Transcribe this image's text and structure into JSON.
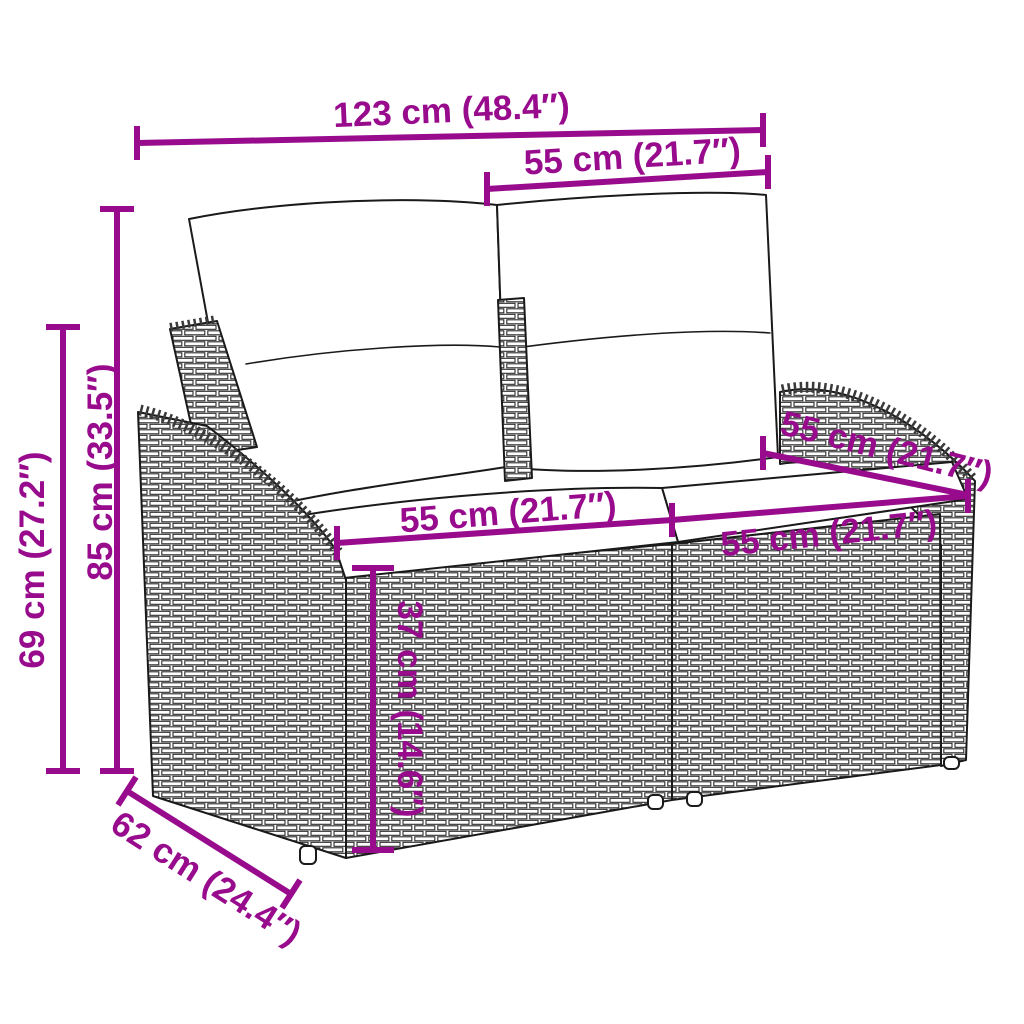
{
  "diagram": {
    "kind": "product-dimension-line-drawing",
    "subject": "poly rattan 2-seater garden sofa with back and seat cushions",
    "background_color": "#FFFFFF",
    "outline_color": "#1A1A1A",
    "dimension_color": "#970B8C",
    "dimensions": {
      "overall_width": "123 cm (48.4″)",
      "backrest_width": "55 cm (21.7″)",
      "overall_height": "85 cm (33.5″)",
      "armrest_height": "69 cm (27.2″)",
      "seat_width_left": "55 cm (21.7″)",
      "seat_width_right": "55 cm (21.7″)",
      "seat_depth": "55 cm (21.7″)",
      "seat_height": "37 cm (14.6″)",
      "base_depth": "62 cm (24.4″)"
    }
  }
}
